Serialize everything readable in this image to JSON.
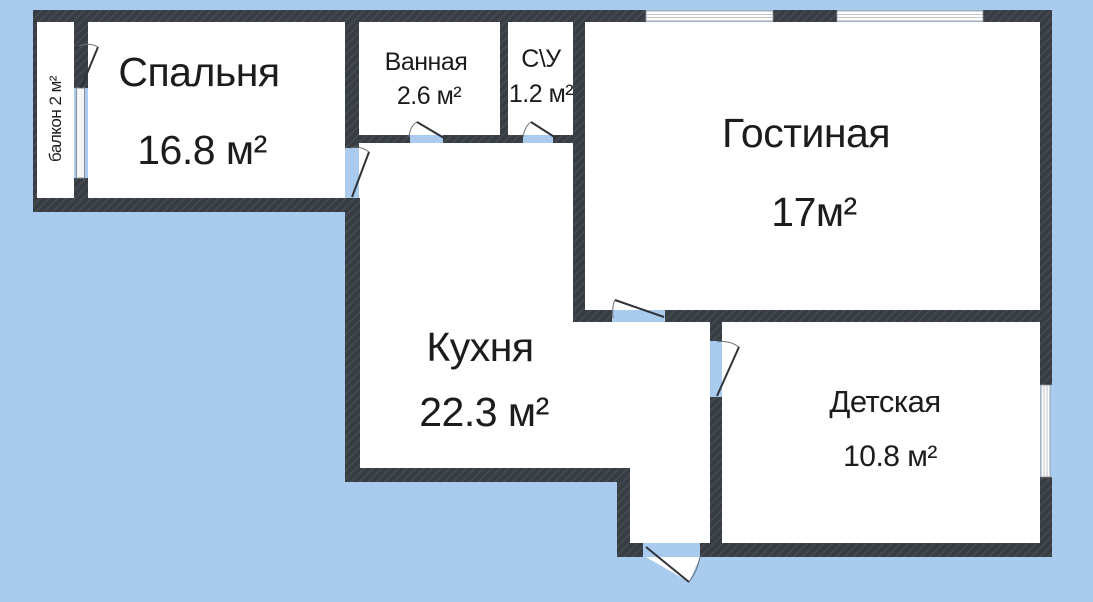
{
  "plan": {
    "colors": {
      "background": "#a9cbee",
      "wall": "#3a3f45",
      "wall_hatch": "#454b52",
      "room_fill": "#ffffff",
      "text": "#1c1c1c",
      "window_frame": "#8a9096"
    },
    "rooms": [
      {
        "id": "bedroom",
        "name": "Спальня",
        "area": "16.8 м²"
      },
      {
        "id": "bathroom",
        "name": "Ванная",
        "area": "2.6 м²"
      },
      {
        "id": "wc",
        "name": "С\\У",
        "area": "1.2 м²"
      },
      {
        "id": "living",
        "name": "Гостиная",
        "area": "17м²"
      },
      {
        "id": "kitchen",
        "name": "Кухня",
        "area": "22.3 м²"
      },
      {
        "id": "kids",
        "name": "Детская",
        "area": "10.8 м²"
      },
      {
        "id": "balcony",
        "name": "балкон 2 м²"
      }
    ]
  }
}
